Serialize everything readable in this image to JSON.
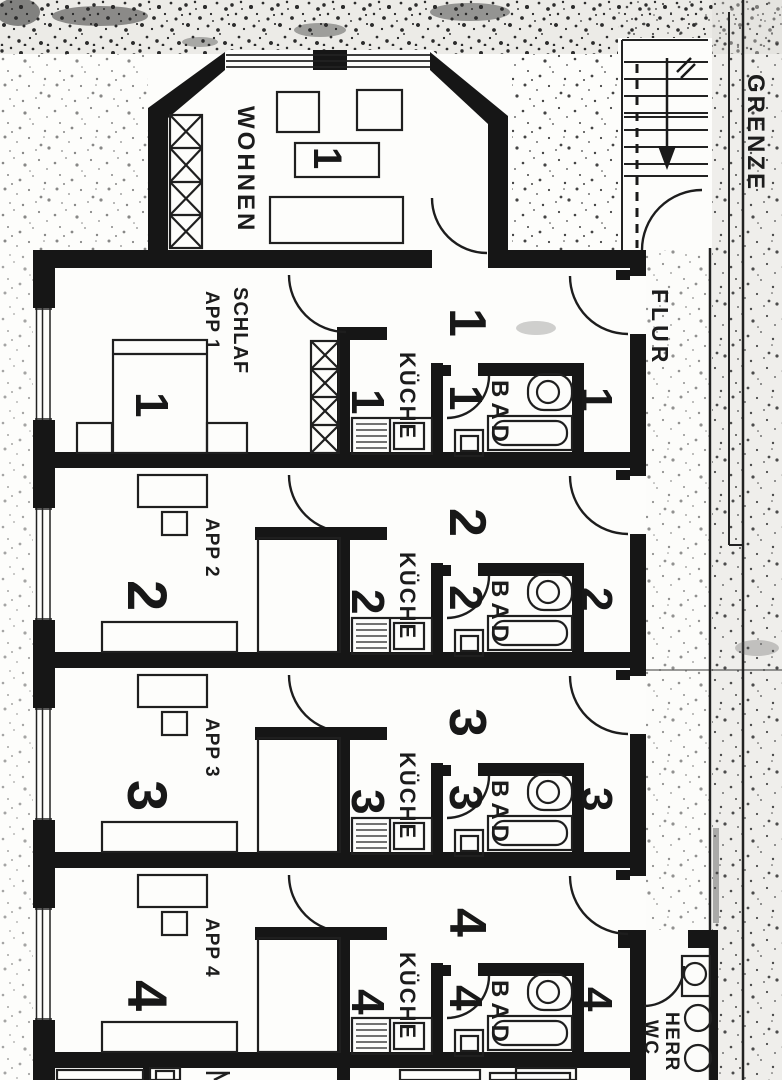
{
  "plan": {
    "labels": {
      "wohnen": "WOHNEN",
      "schlaf": "SCHLAF",
      "kueche": "KÜCHE",
      "bad": "BAD",
      "flur": "FLUR",
      "grenze": "GRENZE",
      "wc_line1": "HERR",
      "wc_line2": "WC"
    },
    "apartments": [
      {
        "name": "APP 1",
        "no": "1"
      },
      {
        "name": "APP 2",
        "no": "2"
      },
      {
        "name": "APP 3",
        "no": "3"
      },
      {
        "name": "APP 4",
        "no": "4"
      }
    ]
  }
}
